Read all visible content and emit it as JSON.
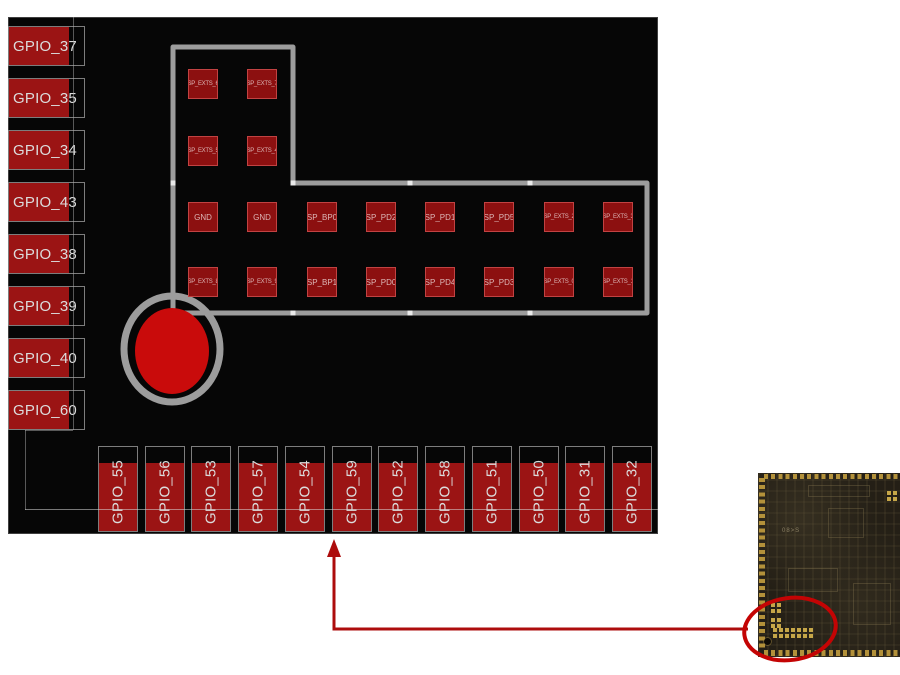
{
  "board": {
    "left_pads": [
      "GPIO_37",
      "GPIO_35",
      "GPIO_34",
      "GPIO_43",
      "GPIO_38",
      "GPIO_39",
      "GPIO_40",
      "GPIO_60"
    ],
    "bottom_pads": [
      "GPIO_55",
      "GPIO_56",
      "GPIO_53",
      "GPIO_57",
      "GPIO_54",
      "GPIO_59",
      "GPIO_52",
      "GPIO_58",
      "GPIO_51",
      "GPIO_50",
      "GPIO_31",
      "GPIO_32"
    ],
    "pad_grid": {
      "row1": [
        "SP_EXTS_6",
        "SP_EXTS_7"
      ],
      "row2": [
        "SP_EXTS_5",
        "SP_EXTS_4"
      ],
      "row3": [
        "GND",
        "GND",
        "SP_BP0",
        "SP_PD2",
        "SP_PD1",
        "SP_PD5",
        "SP_EXTS_2",
        "SP_EXTS_3"
      ],
      "row4": [
        "SP_EXTS_8",
        "SP_EXTS_9",
        "SP_BP1",
        "SP_PD0",
        "SP_PD4",
        "SP_PD3",
        "SP_EXTS_0",
        "SP_EXTS_1"
      ]
    }
  },
  "photo": {
    "silkscreen_marking": "08>S"
  },
  "colors": {
    "board_black": "#060606",
    "pad_red": "#9b1414",
    "grid_pad_red": "#8c1010",
    "grid_pad_border": "#c14242",
    "outline_gray": "#9c9c9c",
    "locating_circle_red": "#c90b0b",
    "annotation_red": "#ad0c0c",
    "ellipse_red": "#c40404",
    "pcb_gold": "#b3913a"
  }
}
